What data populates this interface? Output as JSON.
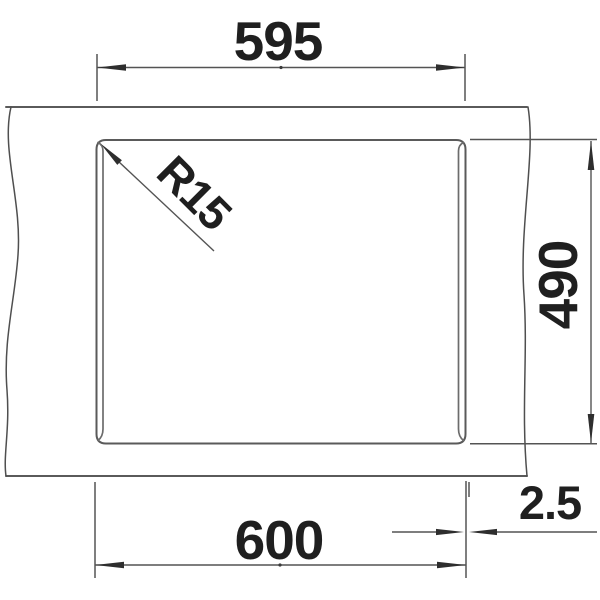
{
  "drawing": {
    "type": "technical-dimension-drawing",
    "subject": "sink top view with countertop break lines",
    "dimensions": {
      "cutout_width": {
        "value": "595"
      },
      "overall_width": {
        "value": "600"
      },
      "depth": {
        "value": "490"
      },
      "edge_offset": {
        "value": "2.5"
      },
      "corner_radius": {
        "value": "R15"
      }
    },
    "colors": {
      "background": "#ffffff",
      "object_line": "#5a5a5a",
      "dimension_line": "#545454",
      "text": "#1f1f1f"
    }
  }
}
